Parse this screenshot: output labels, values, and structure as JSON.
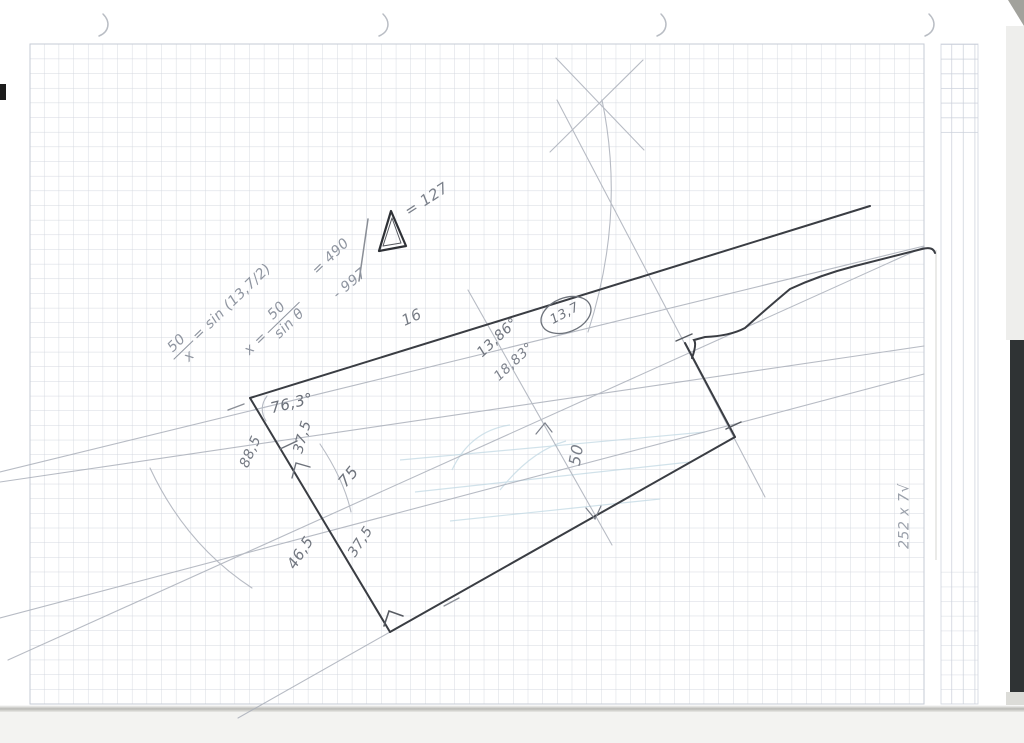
{
  "annotations": {
    "formula_ratio": {
      "numerator": "50",
      "denominator": "x",
      "rhs": "= sin (13,7/2)"
    },
    "formula_solve": {
      "lead": "x =",
      "numerator": "50",
      "denominator": "sin θ",
      "result": "= 490",
      "correction": "- 997"
    },
    "delta_note": "= 127",
    "top_edge_label": "16",
    "angle_upper": "13,86°",
    "angle_lower": "18,83°",
    "circled_value": "13,7",
    "vertex_angle": "76,3°",
    "left_outer_length": "88,5",
    "left_upper_segment": "37,5",
    "left_middle_segment": "75",
    "left_lower_length": "46,5",
    "bottom_segment": "37,5",
    "width_dimension": "50",
    "margin_note": "252 x 7√"
  },
  "colors": {
    "pencil_dark": "#3a3d43",
    "pencil_light": "#abb0ba",
    "grid_line": "#cbd0da",
    "ink_text": "#6e737b",
    "bleed_blue": "#c2d9e4"
  }
}
